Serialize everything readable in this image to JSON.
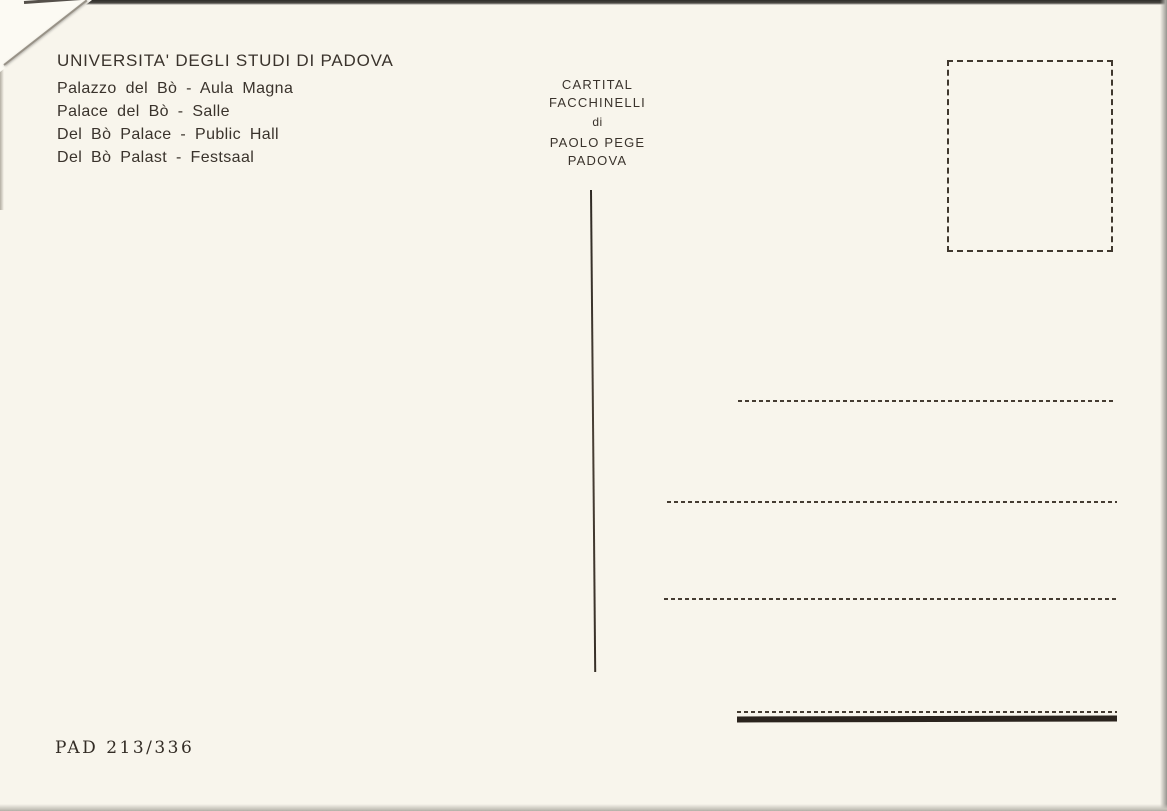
{
  "postcard": {
    "title": "UNIVERSITA' DEGLI STUDI DI PADOVA",
    "captions": [
      "Palazzo del Bò - Aula Magna",
      "Palace del Bò - Salle",
      "Del Bò Palace - Public Hall",
      "Del Bò Palast - Festsaal"
    ],
    "publisher": [
      "CARTITAL",
      "FACCHINELLI",
      "di",
      "PAOLO PEGE",
      "PADOVA"
    ],
    "catalog_number": "PAD 213/336",
    "colors": {
      "paper": "#f8f5ec",
      "ink": "#3a332c",
      "rule": "#453c32",
      "bottom_bar": "#2b241e",
      "photo_edge": "#aaa8a2"
    }
  }
}
